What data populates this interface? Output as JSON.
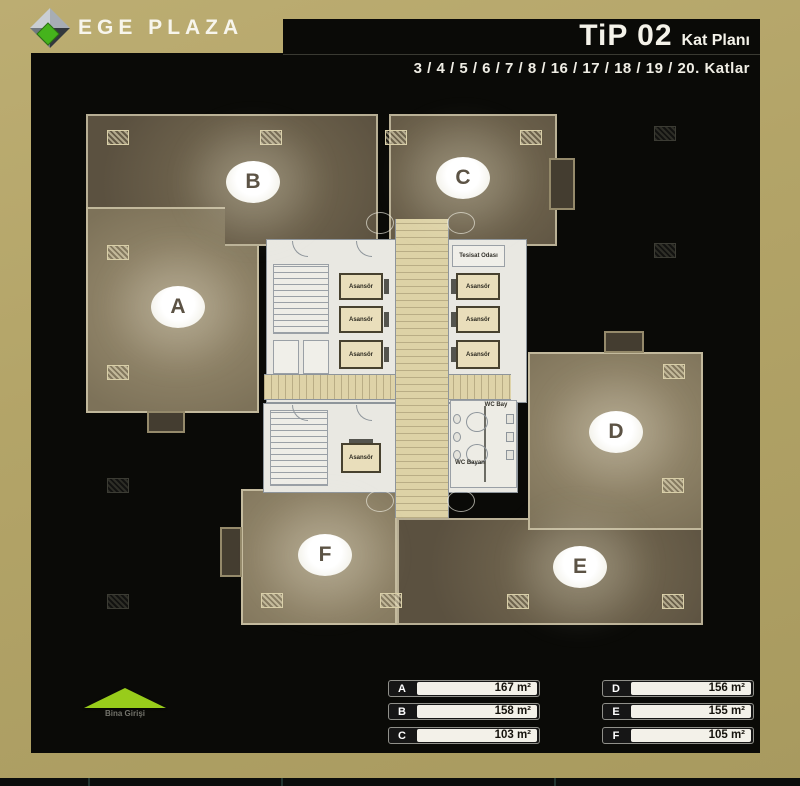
{
  "header": {
    "logo_text": "EGE PLAZA",
    "title": "TiP 02",
    "title_suffix": "Kat Planı",
    "floors_line": "3 / 4 / 5 / 6 / 7 / 8 / 16 / 17 / 18 / 19 / 20. Katlar"
  },
  "plan": {
    "sections": [
      "A",
      "B",
      "C",
      "D",
      "E",
      "F"
    ],
    "elevator_label": "Asansör",
    "utility_room_label": "Tesisat Odası",
    "wc_men_label": "WC Bay",
    "wc_women_label": "WC Bayan",
    "entrance_label": "Bina Girişi"
  },
  "legend": {
    "items": [
      {
        "letter": "A",
        "area": "167 m²"
      },
      {
        "letter": "B",
        "area": "158 m²"
      },
      {
        "letter": "C",
        "area": "103 m²"
      },
      {
        "letter": "D",
        "area": "156 m²"
      },
      {
        "letter": "E",
        "area": "155 m²"
      },
      {
        "letter": "F",
        "area": "105 m²"
      }
    ]
  },
  "colors": {
    "gold": "#b3a468",
    "panel_black": "#0a0a07",
    "section_dark": "#6a5f4a",
    "section_light": "#8d8166",
    "core_white": "#e9e8e2",
    "corridor_beige": "#ddd2a6",
    "entrance_green": "#98cc1b"
  }
}
